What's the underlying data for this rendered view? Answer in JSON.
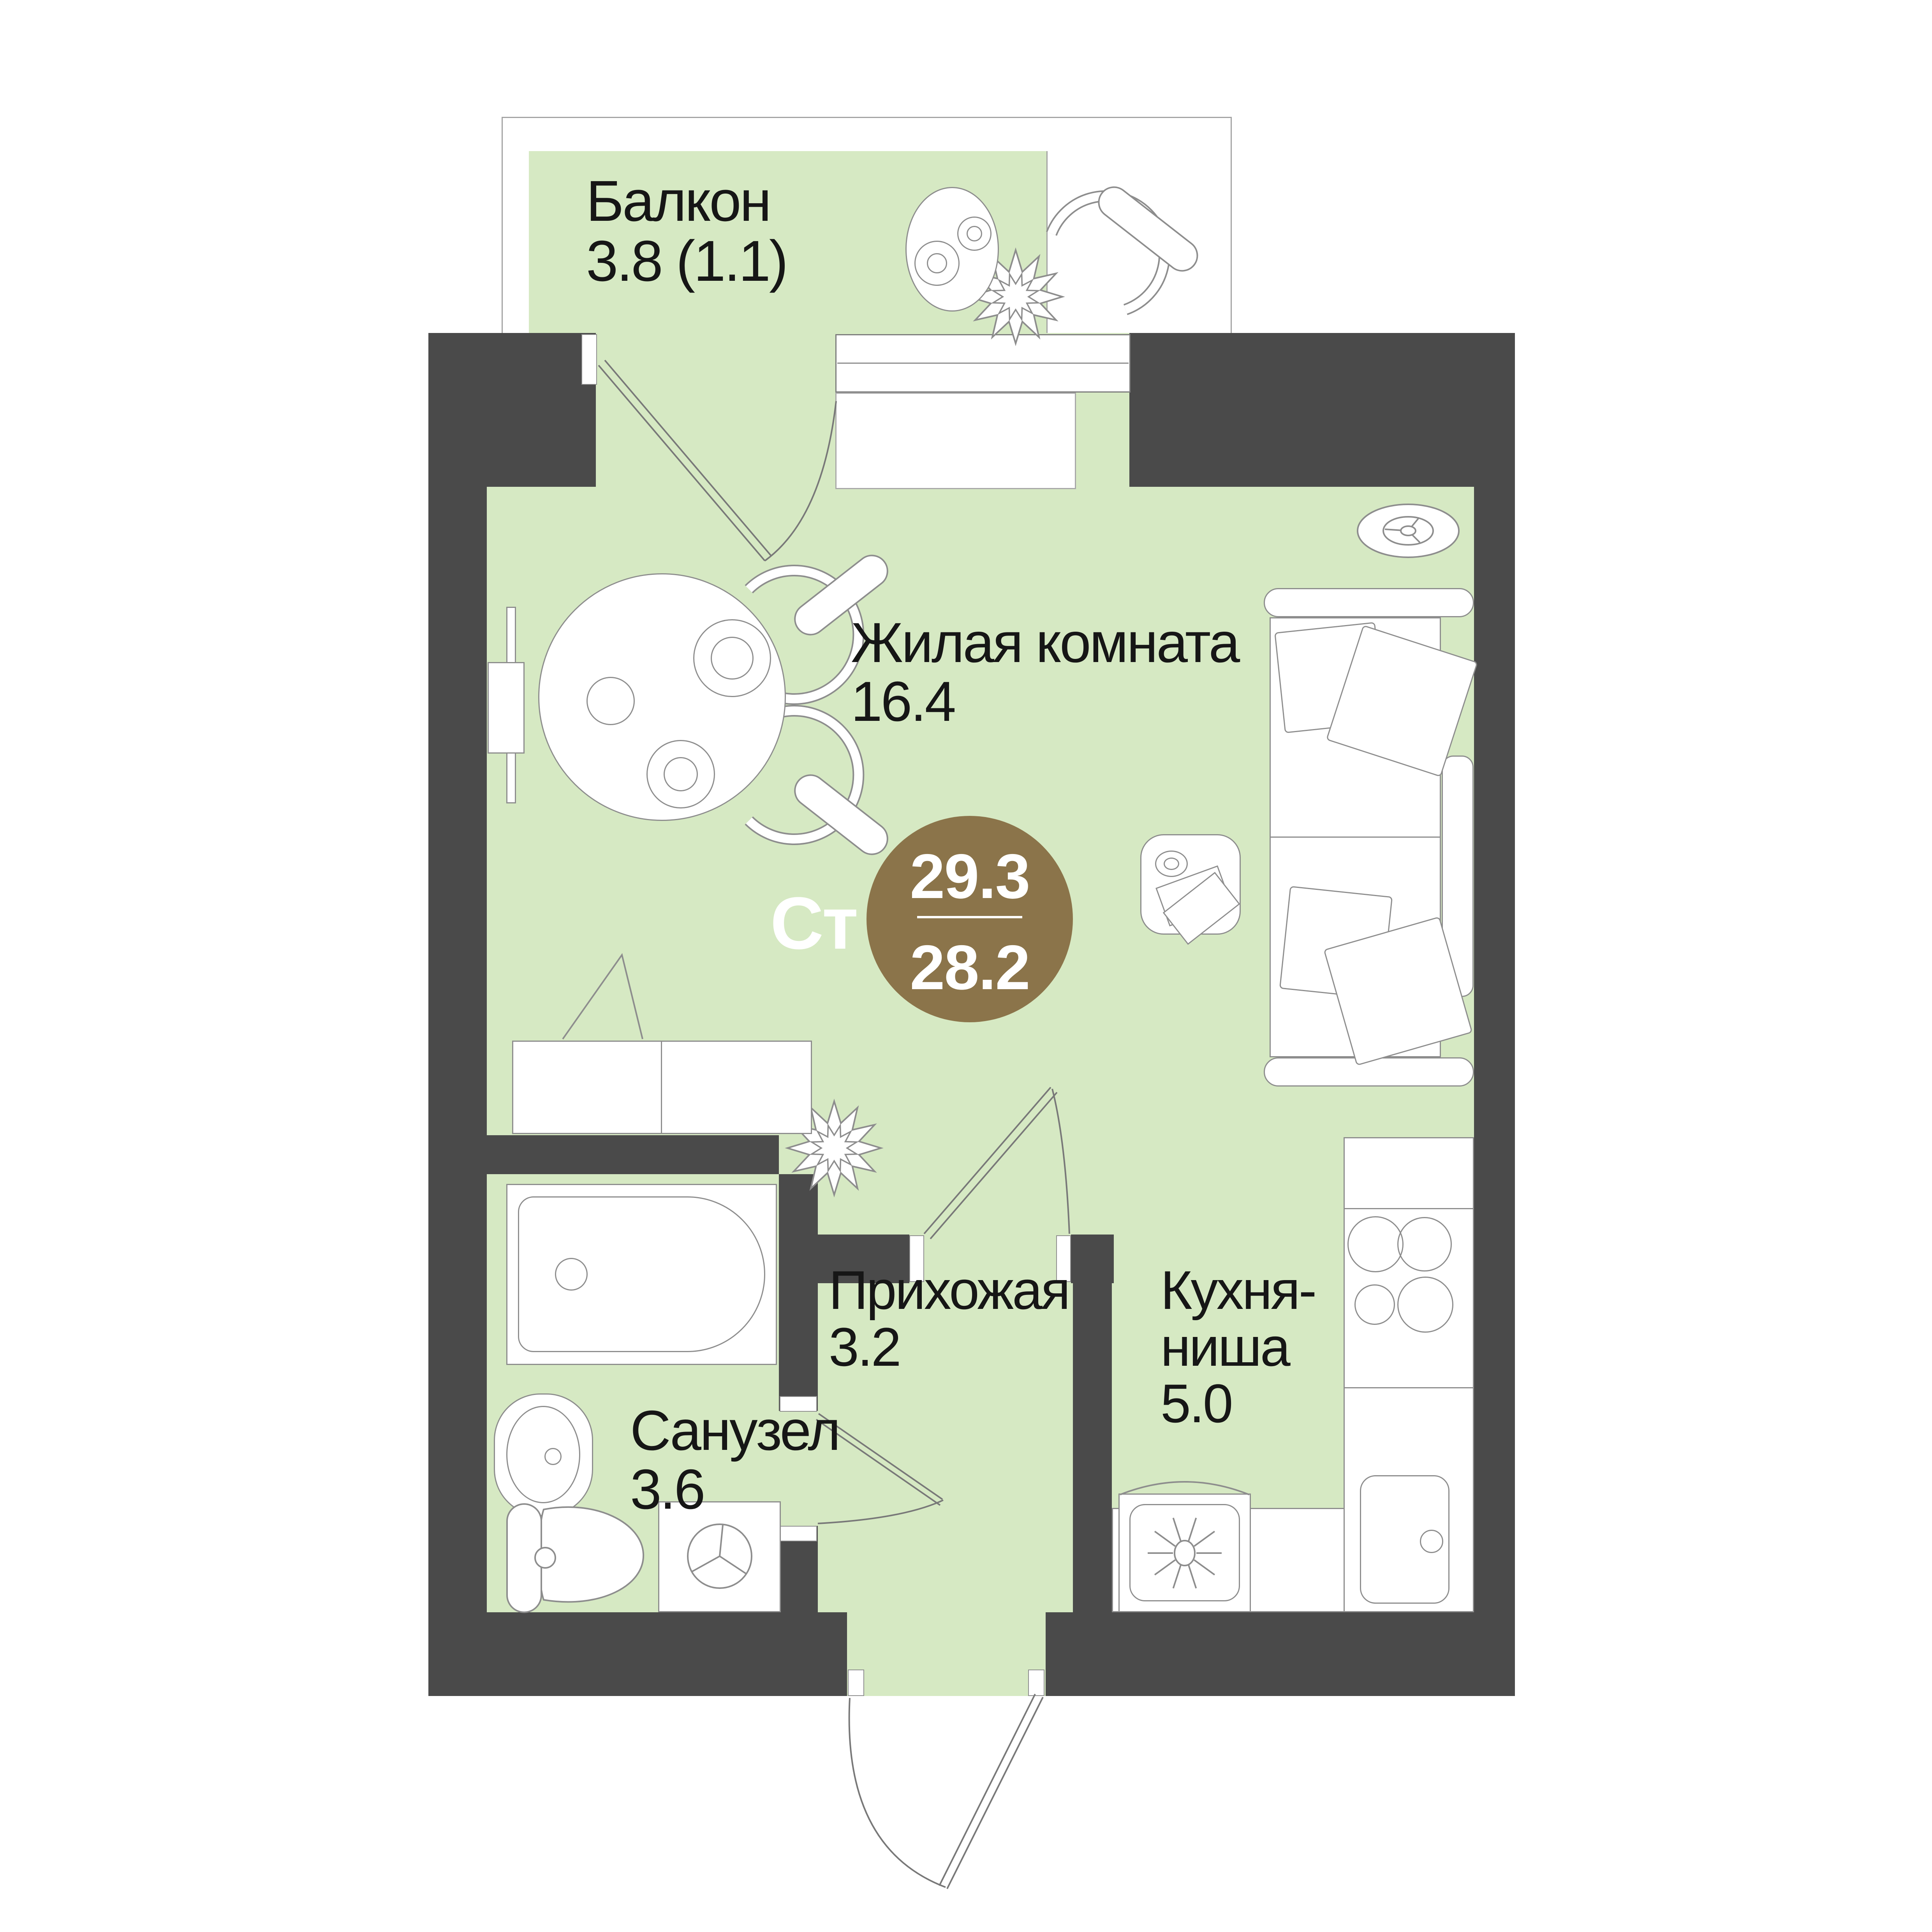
{
  "plan_type": "studio-floor-plan",
  "badge": {
    "code": "Ст",
    "area_total": "29.3",
    "area_living": "28.2"
  },
  "labels": {
    "balcony": {
      "l1": "Балкон",
      "l2": "3.8 (1.1)"
    },
    "living": {
      "l1": "Жилая комната",
      "l2": "16.4"
    },
    "hall": {
      "l1": "Прихожая",
      "l2": "3.2"
    },
    "kitchen": {
      "l1": "Кухня-",
      "l2": "ниша",
      "l3": "5.0"
    },
    "bath": {
      "l1": "Санузел",
      "l2": "3.6"
    }
  },
  "colors": {
    "wall": "#4a4a4a",
    "floor": "#d6e9c3",
    "badge": "#8b744a",
    "outline": "#8d8d8d",
    "text": "#161616",
    "badge_text": "#ffffff"
  }
}
